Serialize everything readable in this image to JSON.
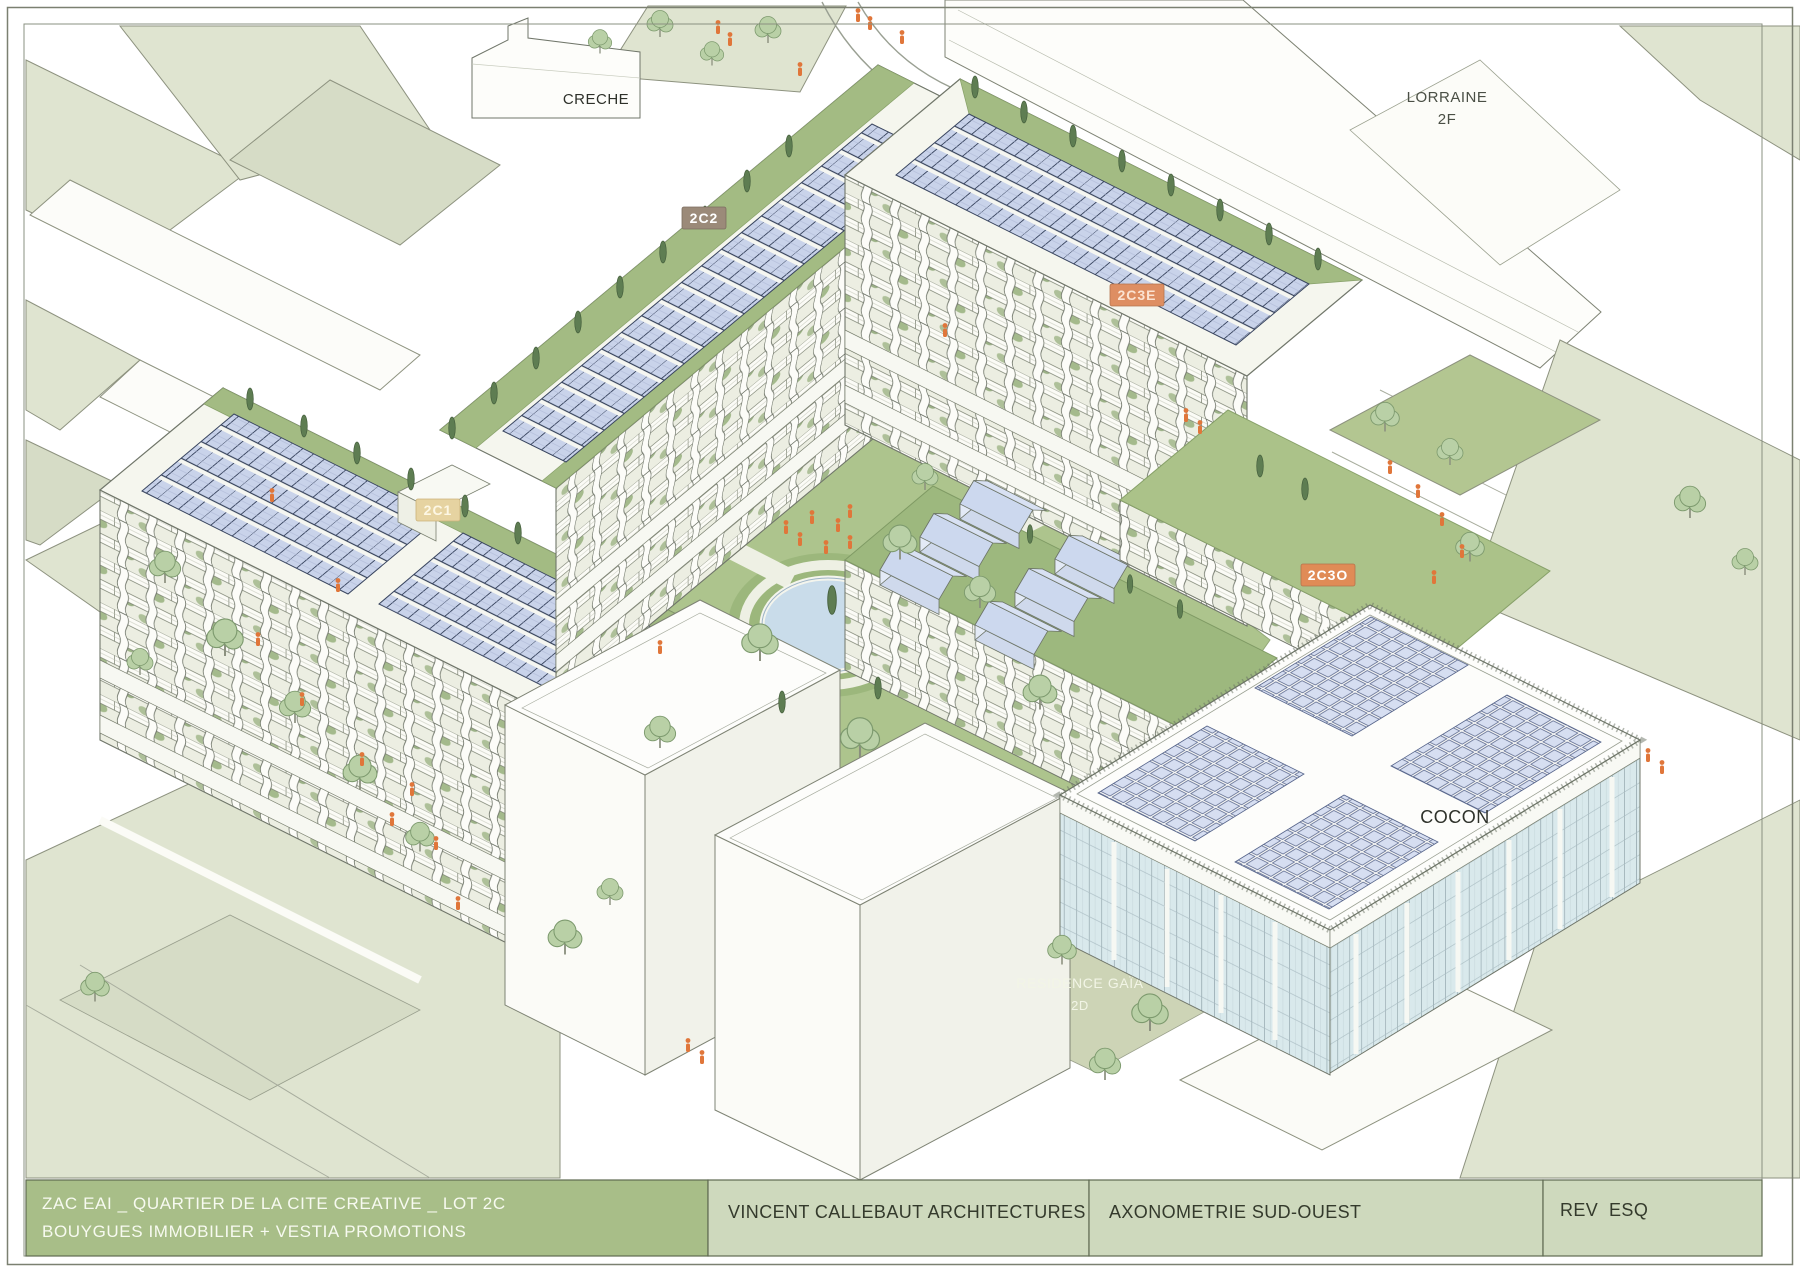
{
  "page": {
    "background": "#ffffff",
    "frame_color": "#7d8273"
  },
  "drawing": {
    "labels": {
      "creche": "CRECHE",
      "lorraine_line1": "LORRAINE",
      "lorraine_line2": "2F",
      "cocon": "COCON",
      "residence_line1": "RESIDENCE GAÏA",
      "residence_line2": "2D"
    },
    "badges": [
      {
        "label": "2C2",
        "color": "#9b8a79",
        "text_color": "#ffffff"
      },
      {
        "label": "2C1",
        "color": "#e6d3a1",
        "text_color": "#fdf7e4"
      },
      {
        "label": "2C3E",
        "color": "#de8e62",
        "text_color": "#fbe3d2"
      },
      {
        "label": "2C3O",
        "color": "#e08b56",
        "text_color": "#ffffff"
      }
    ],
    "palette": {
      "roof_pale_green": "#dfe4d0",
      "lawn_green": "#adc48d",
      "solar_panel_blue": "#c9d3ea",
      "glass_blue": "#d9e9ec",
      "people_orange": "#e0763a",
      "tree_green": "#b9d0a6",
      "cypress_green": "#5e7d52",
      "pond_blue": "#c9dcea"
    }
  },
  "title_block": {
    "project_line1": "ZAC EAI _ QUARTIER DE LA CITE CREATIVE _ LOT 2C",
    "project_line2": "BOUYGUES IMMOBILIER + VESTIA PROMOTIONS",
    "architect": "VINCENT CALLEBAUT ARCHITECTURES",
    "view_title": "AXONOMETRIE SUD-OUEST",
    "revision": "REV  ESQ"
  }
}
